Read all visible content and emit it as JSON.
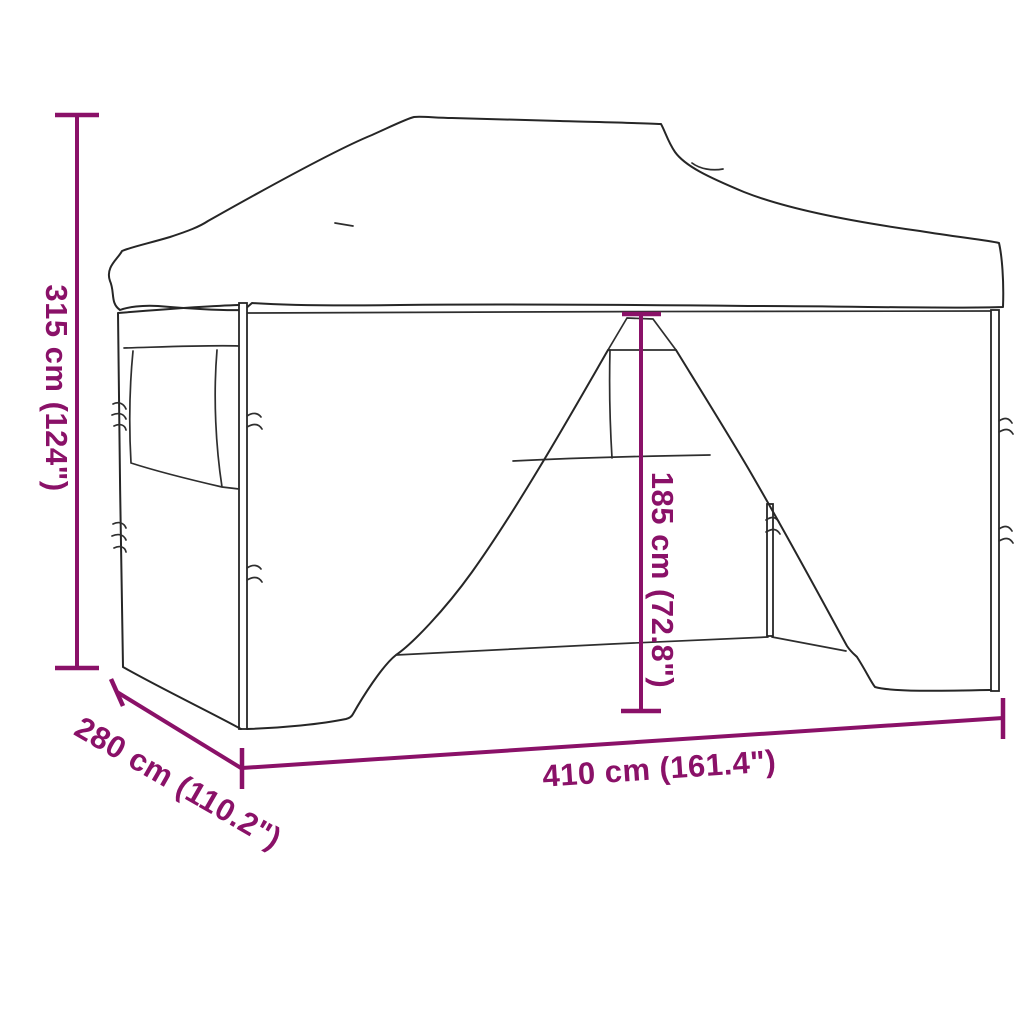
{
  "diagram": {
    "kind": "product-dimension-line-drawing",
    "subject": "pop-up gazebo tent with sidewalls and tied-back door flaps",
    "background_color": "#ffffff"
  },
  "colors": {
    "dimension_annotation": "#8a1168",
    "drawing_outline": "#262626"
  },
  "dimensions": [
    {
      "id": "overall_height",
      "label": "315 cm (124\")",
      "cm": "315 cm",
      "inches": "124\"",
      "orientation": "vertical-left"
    },
    {
      "id": "depth",
      "label": "280 cm (110.2\")",
      "cm": "280 cm",
      "inches": "110.2\"",
      "orientation": "diagonal-bottom-left"
    },
    {
      "id": "width",
      "label": "410 cm (161.4\")",
      "cm": "410 cm",
      "inches": "161.4\"",
      "orientation": "horizontal-bottom"
    },
    {
      "id": "door_height",
      "label": "185 cm (72.8\")",
      "cm": "185 cm",
      "inches": "72.8\"",
      "orientation": "vertical-center"
    }
  ]
}
